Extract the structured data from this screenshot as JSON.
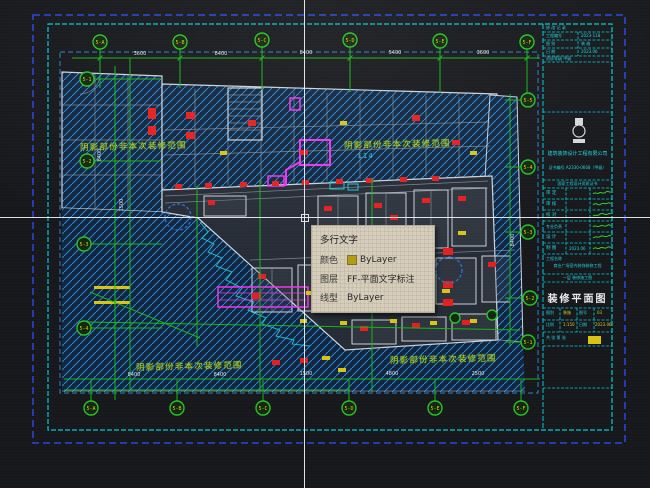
{
  "app": {
    "type": "cad-viewport"
  },
  "colors": {
    "background": "#17181c",
    "frame_outer_blue": "#2947e0",
    "frame_inner_cyan": "#00c9d6",
    "viewport_blue": "#2a7fd0",
    "dim_green": "#17b417",
    "bubble_text_yellow": "#d9ce14",
    "hatch_blue": "#2f7fc4",
    "entity_red": "#e51f1f",
    "entity_yellow": "#d9c414",
    "entity_magenta": "#f032f0",
    "tooltip_bg": "#d6cdbb",
    "crosshair_white": "#f0f4f8"
  },
  "tooltip": {
    "title": "多行文字",
    "color_label": "颜色",
    "color_value": "ByLayer",
    "layer_label": "图层",
    "layer_value": "FF-平面文字标注",
    "linetype_label": "线型",
    "linetype_value": "ByLayer",
    "swatch_color": "#b39b12"
  },
  "notes": {
    "shaded": "阴影部份非本次装修范围",
    "l14": "L14"
  },
  "axis": {
    "top": [
      "5-A",
      "5-B",
      "5-C",
      "5-D",
      "5-E",
      "5-F"
    ],
    "bottom": [
      "5-A",
      "5-B",
      "5-C",
      "5-D",
      "5-E",
      "5-F"
    ],
    "left": [
      "5-1",
      "5-2",
      "5-3",
      "5-4"
    ],
    "right": [
      "5-5",
      "5-4",
      "5-3",
      "5-2",
      "5-1"
    ]
  },
  "dims": {
    "top": [
      "3600",
      "8400",
      "8400",
      "5400",
      "3600"
    ],
    "bottom": [
      "8400",
      "8400",
      "1500",
      "4800",
      "2500"
    ],
    "left": [
      "8400",
      "1500"
    ],
    "right": [
      "8400"
    ]
  },
  "titleblock": {
    "header_row1": "修 改 记 录",
    "h2_label": "工程编号",
    "h2_value": "2023-118",
    "h3_label": "图  别",
    "h3_value": "装 施",
    "h4_label": "日  期",
    "h4_value": "2023.06",
    "h5_label": "资质等级 甲级",
    "company": "建筑装饰设计工程有限公司",
    "cert": "证书编号 A2330-0668（甲级）",
    "cert_small": "国家工程设计资质证书",
    "sign_labels": [
      "审 定",
      "审 核",
      "校 对",
      "专业负责",
      "设 计",
      "制 图"
    ],
    "sign_date": "2023.06",
    "project_label": "工程名称",
    "project_value": "商业广场室内装饰装修工程",
    "subproject": "一层 装修施工图",
    "title": "装修平面图",
    "grid": {
      "f1l": "图别",
      "f1v": "装施",
      "f2l": "图号",
      "f2v": "03",
      "f3l": "比例",
      "f3v": "1:150",
      "f4l": "日期",
      "f4v": "2023.06",
      "pages": "共 张 第 张"
    }
  }
}
